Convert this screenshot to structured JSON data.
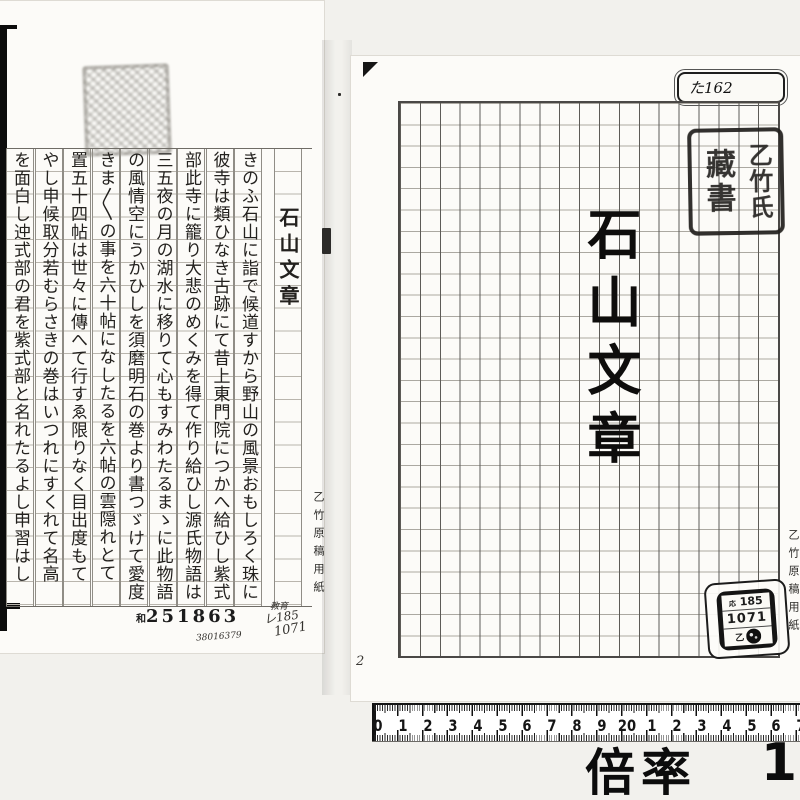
{
  "left_page": {
    "title": "石山文章",
    "text_columns": [
      "きのふ石山に詣で候道すから野山の風景おもしろく珠に",
      "彼寺は類ひなき古跡にて昔上東門院につかへ給ひし紫式",
      "部此寺に籠り大悲のめくみを得て作り給ひし源氏物語は",
      "三五夜の月の湖水に移りて心もすみわたるまゝに此物語",
      "の風情空にうかひしを須磨明石の巻より書つゞけて愛度",
      "きま〱の事を六十帖になしたるを六帖の雲隠れとて",
      "置五十四帖は世々に傳へて行すゑ限りなく目出度もて",
      "やし申候取分若むらさきの巻はいつれにすくれて名高",
      "を面白し迚式部の君を紫式部と名れたるよし申習はし"
    ],
    "margin_label": "乙竹原稿用紙",
    "accession_prefix": "和",
    "accession_number": "251863",
    "note_kyoiku": "教育",
    "note_re": "レ185",
    "note_1071": "1071",
    "note_serial": "38016379"
  },
  "right_page": {
    "tag_label": "た162",
    "calligraphy_title": "石山文章",
    "seal_right": "乙竹氏",
    "seal_left": "藏書",
    "catalog_prefix": "応",
    "catalog_number": "185",
    "catalog_code": "1071",
    "catalog_seal_char": "乙",
    "margin_label": "乙竹原稿用紙",
    "gutter_note": "2"
  },
  "ruler": {
    "numbers": [
      "0",
      "1",
      "2",
      "3",
      "4",
      "5",
      "6",
      "7",
      "8",
      "9",
      "20",
      "1",
      "2",
      "3",
      "4",
      "5",
      "6",
      "7"
    ]
  },
  "caption": {
    "label": "倍率",
    "value": "1"
  }
}
